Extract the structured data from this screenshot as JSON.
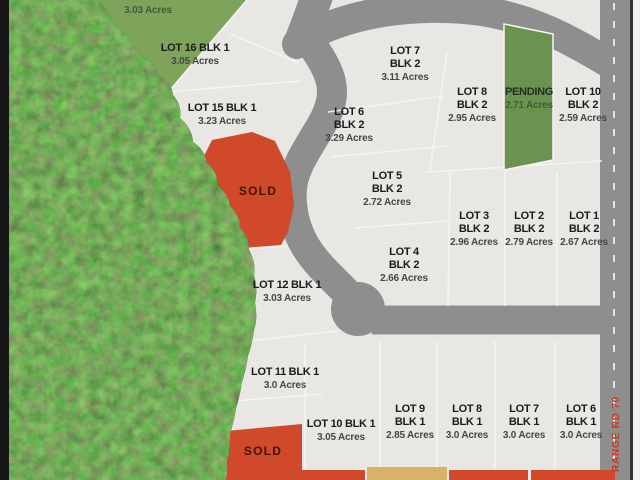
{
  "map": {
    "type": "subdivision-plat-map",
    "roads": {
      "range_rd": "RANGE RD 70"
    },
    "colors": {
      "background": "#e8e7e4",
      "road": "#8e8e8e",
      "forest": "#223d1c",
      "sold": "#d0492a",
      "pending": "#6a9350",
      "pending_light": "#7ea45b",
      "tan": "#d9b269",
      "boundary_line": "#f7f6f3",
      "left_border": "#161616",
      "right_margin": "#f3f2ef",
      "edge_line": "#333333",
      "range_rd_text": "#c23b26"
    },
    "lots": {
      "pending_top": {
        "status": "PENDING",
        "acres": "3.03 Acres"
      },
      "lot16_blk1": {
        "name": "LOT 16 BLK 1",
        "acres": "3.05 Acres"
      },
      "lot15_blk1": {
        "name": "LOT 15 BLK 1",
        "acres": "3.23 Acres"
      },
      "sold_mid": {
        "status": "SOLD"
      },
      "lot12_blk1": {
        "name": "LOT 12 BLK 1",
        "acres": "3.03 Acres"
      },
      "lot11_blk1": {
        "name": "LOT 11 BLK 1",
        "acres": "3.0 Acres"
      },
      "sold_bottom": {
        "status": "SOLD"
      },
      "lot10_blk1": {
        "name": "LOT 10 BLK 1",
        "acres": "3.05 Acres"
      },
      "lot9_blk1": {
        "name": "LOT 9",
        "block": "BLK 1",
        "acres": "2.85 Acres"
      },
      "lot8_blk1": {
        "name": "LOT 8",
        "block": "BLK 1",
        "acres": "3.0 Acres"
      },
      "lot7_blk1": {
        "name": "LOT 7",
        "block": "BLK 1",
        "acres": "3.0 Acres"
      },
      "lot6_blk1": {
        "name": "LOT 6",
        "block": "BLK 1",
        "acres": "3.0 Acres"
      },
      "lot7_blk2": {
        "name": "LOT 7",
        "block": "BLK 2",
        "acres": "3.11 Acres"
      },
      "lot8_blk2": {
        "name": "LOT 8",
        "block": "BLK 2",
        "acres": "2.95 Acres"
      },
      "pending_strip": {
        "status": "PENDING",
        "acres": "2.71 Acres"
      },
      "lot10_blk2": {
        "name": "LOT 10",
        "block": "BLK 2",
        "acres": "2.59 Acres"
      },
      "lot6_blk2": {
        "name": "LOT 6",
        "block": "BLK 2",
        "acres": "3.29 Acres"
      },
      "lot5_blk2": {
        "name": "LOT 5",
        "block": "BLK 2",
        "acres": "2.72 Acres"
      },
      "lot4_blk2": {
        "name": "LOT 4",
        "block": "BLK 2",
        "acres": "2.66 Acres"
      },
      "lot3_blk2": {
        "name": "LOT 3",
        "block": "BLK 2",
        "acres": "2.96 Acres"
      },
      "lot2_blk2": {
        "name": "LOT 2",
        "block": "BLK 2",
        "acres": "2.79 Acres"
      },
      "lot1_blk2": {
        "name": "LOT 1",
        "block": "BLK 2",
        "acres": "2.67 Acres"
      }
    }
  }
}
